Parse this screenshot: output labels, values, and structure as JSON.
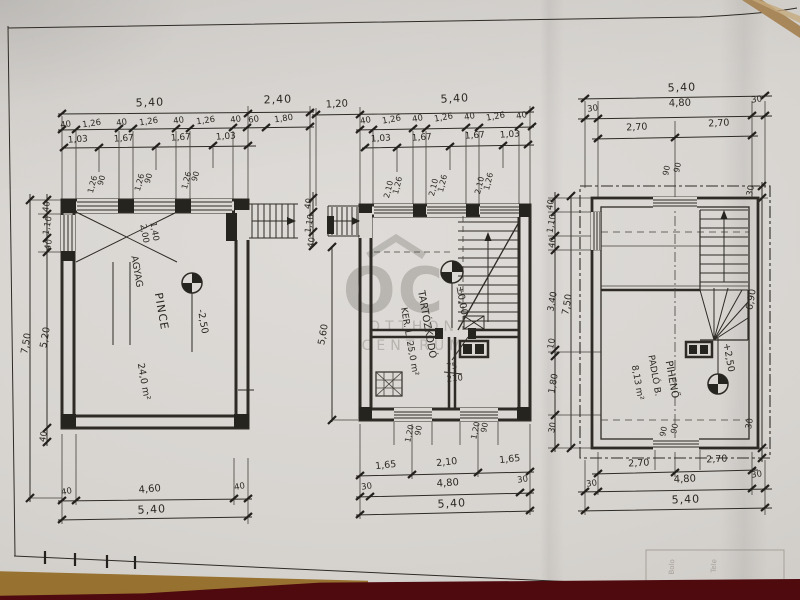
{
  "watermark": {
    "logo": "OC",
    "line1": "OTTHON",
    "line2": "CENTRUM"
  },
  "sheet": {
    "fragments": [
      "Bolo",
      "Tele"
    ]
  },
  "basement": {
    "room": "PINCE",
    "soil": "AGYAG",
    "area": "24,0 m²",
    "level": "-2,50",
    "shaft": [
      "1,40",
      "2,00"
    ],
    "top_main": [
      "5,40",
      "2,40"
    ],
    "top_segs": [
      "40",
      "1,26",
      "40",
      "1,26",
      "40",
      "1,26",
      "40",
      "60",
      "1,80"
    ],
    "top_axes": [
      "1,03",
      "1,67",
      "1,67",
      "1,03"
    ],
    "windows": [
      [
        "1,26",
        "90"
      ],
      [
        "1,26",
        "90"
      ],
      [
        "1,26",
        "90"
      ]
    ],
    "left": [
      "40",
      "1,10",
      "40",
      "5,20",
      "7,50",
      "40"
    ],
    "bottom": [
      "40",
      "4,60",
      "40",
      "5,40"
    ]
  },
  "ground": {
    "room": "TARTÓZKODÓ",
    "room2": "KER. L. 25,0 m²",
    "level": "±0,00",
    "door": [
      "75",
      "210"
    ],
    "top_main": [
      "1,20",
      "5,40"
    ],
    "top_segs": [
      "40",
      "1,26",
      "40",
      "1,26",
      "40",
      "1,26",
      "40"
    ],
    "top_axes": [
      "1,03",
      "1,67",
      "1,67",
      "1,03"
    ],
    "windows_top": [
      [
        "2,10",
        "1,26"
      ],
      [
        "2,10",
        "1,26"
      ],
      [
        "2,10",
        "1,26"
      ]
    ],
    "left": [
      "40",
      "1,10",
      "40",
      "5,60"
    ],
    "windows_bottom": [
      [
        "1,20",
        "90"
      ],
      [
        "1,20",
        "90"
      ]
    ],
    "bottom1": [
      "1,65",
      "2,10",
      "1,65"
    ],
    "bottom2": [
      "30",
      "4,80",
      "30"
    ],
    "bottom_total": "5,40"
  },
  "upper": {
    "room": "PIHENŐ",
    "room2": "PADLÓ B.",
    "area": "8,13 m²",
    "level": "+2,50",
    "top_total": "5,40",
    "top2": [
      "30",
      "4,80",
      "30"
    ],
    "top3": [
      "2,70",
      "2,70"
    ],
    "windows_top": [
      "90",
      "90"
    ],
    "left": [
      "40",
      "1,10",
      "40",
      "3,40",
      "10",
      "1,80",
      "30"
    ],
    "left_total": "7,50",
    "right": [
      "30",
      "6,90",
      "30"
    ],
    "windows_bottom": [
      "90",
      "90"
    ],
    "bottom1": [
      "2,70",
      "2,70"
    ],
    "bottom2": [
      "30",
      "4,80",
      "30"
    ],
    "bottom_total": "5,40"
  }
}
